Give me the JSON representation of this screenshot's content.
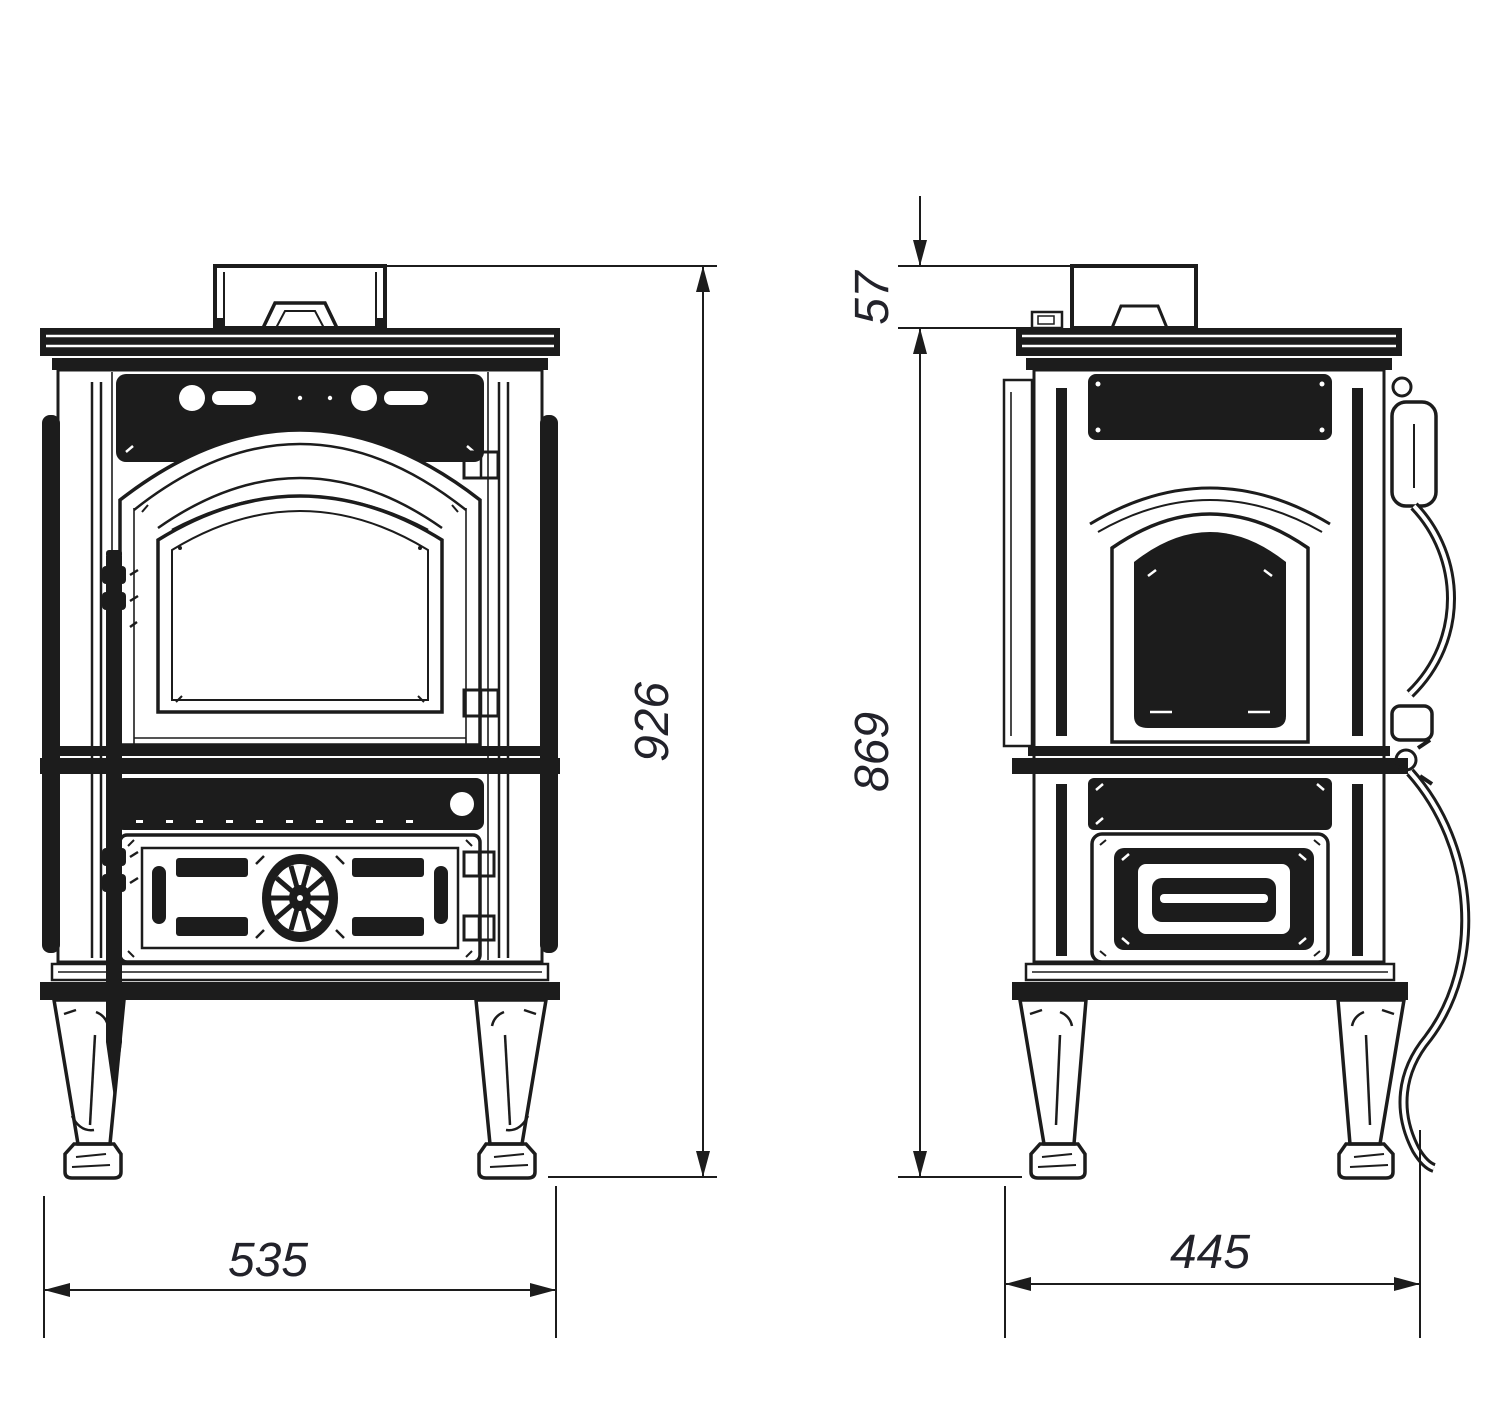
{
  "drawing_type": "stove dimensional technical drawing, front and side views",
  "colors": {
    "line": "#1c1c1c",
    "background": "#ffffff"
  },
  "dimension_labels": {
    "front_width": "535",
    "front_overall_height": "926",
    "side_flue_offset": "57",
    "side_body_height": "869",
    "side_depth": "445"
  }
}
